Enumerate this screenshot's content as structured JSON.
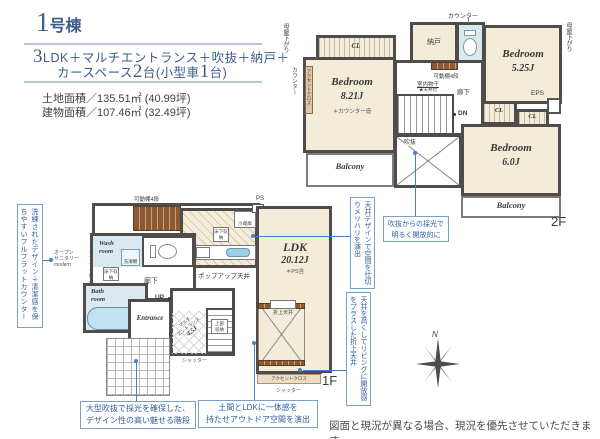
{
  "colors": {
    "accent_text_blue": "#2f5e9e",
    "header_navy": "#3d5c88",
    "room_beige": "#f2ecd9",
    "wall_gray": "#4f4c49",
    "water_blue": "#d9e9ef",
    "wood_brown": "#8a5a36",
    "leader_blue": "#4a7fc1"
  },
  "header": {
    "title_num": "1",
    "title_suffix": "号棟",
    "spec1_num": "3",
    "spec1_rest": "LDK＋マルチエントランス＋吹抜＋納戸＋",
    "spec2_a": "カースペース",
    "spec2_num1": "2",
    "spec2_b": "台(小型車",
    "spec2_num2": "1",
    "spec2_c": "台)",
    "land_area": "土地面積／135.51㎡ (40.99坪)",
    "building_area": "建物面積／107.46㎡ (32.49坪)"
  },
  "f2": {
    "floor_label": "2F",
    "moya_left": "母屋下がり",
    "counter_side": "カウンター",
    "moya_right": "母屋下がり",
    "counter_top": "カウンター",
    "nando": "納戸",
    "kadou": "可動棚4段",
    "monohoshi": "室内物干",
    "monohoshi_note": "★天井付",
    "rouka": "廊下",
    "dn": "DN",
    "fukinuke": "吹抜",
    "accent_wall": "アクセントクロス",
    "eps": "EPS",
    "cl1": "CL",
    "cl2": "CL",
    "cl3": "CL",
    "bed1": {
      "name": "Bedroom",
      "size": "8.21J",
      "note": "＊カウンター造"
    },
    "bed2": {
      "name": "Bedroom",
      "size": "5.25J"
    },
    "bed3": {
      "name": "Bedroom",
      "size": "6.0J"
    },
    "balcony1": "Balcony",
    "balcony2": "Balcony"
  },
  "f1": {
    "floor_label": "1F",
    "kadou": "可動棚4段",
    "ps": "PS",
    "reizouko": "冷蔵庫",
    "yukashita_kitchen": "床下収納",
    "yukashita_hall": "床下収納",
    "ldk": {
      "name": "LDK",
      "size": "20.12J",
      "note": "＊PS含"
    },
    "popup": "ポップアップ天井",
    "wash_l1": "Wash",
    "wash_l2": "room",
    "sentakki": "洗濯機",
    "accent_wall": "アクセントクロス",
    "rouka": "廊下",
    "sanitary_l1": "オープン",
    "sanitary_l2": "サニタリー",
    "sanitary_l3": "modern",
    "bath_l1": "Bath",
    "bath_l2": "room",
    "up": "UP",
    "entrance": "Entrance",
    "doma_l1": "マルチ",
    "doma_l2": "エントランス",
    "doma_l3": "4.5J",
    "joubu_l1": "上部",
    "joubu_l2": "収納",
    "oriage": "折上天井",
    "accent_band": "アクセントクロス",
    "shutter_mid": "シャッター",
    "shutter_right": "シャッター"
  },
  "annotations": {
    "counter": "洗練されたデザイン＋清潔感を保ちやすいフルフラットカウンター",
    "void_l1": "吹抜からの採光で",
    "void_l2": "明るく開放的に",
    "ceiling_zone": "天井デザインで空間を仕切りメリハリを演出",
    "coffered": "天井を高くしてリビングに開放感をプラスした折上天井",
    "stairs_l1": "大型吹抜で採光を確保した、",
    "stairs_l2": "デザイン性の高い魅せる階段",
    "doma_l1": "土間とLDKに一体感を",
    "doma_l2": "持たせアウトドア空間を演出"
  },
  "compass": {
    "north": "N"
  },
  "footer": {
    "disclaimer": "図面と現況が異なる場合、現況を優先させていただきます。"
  }
}
